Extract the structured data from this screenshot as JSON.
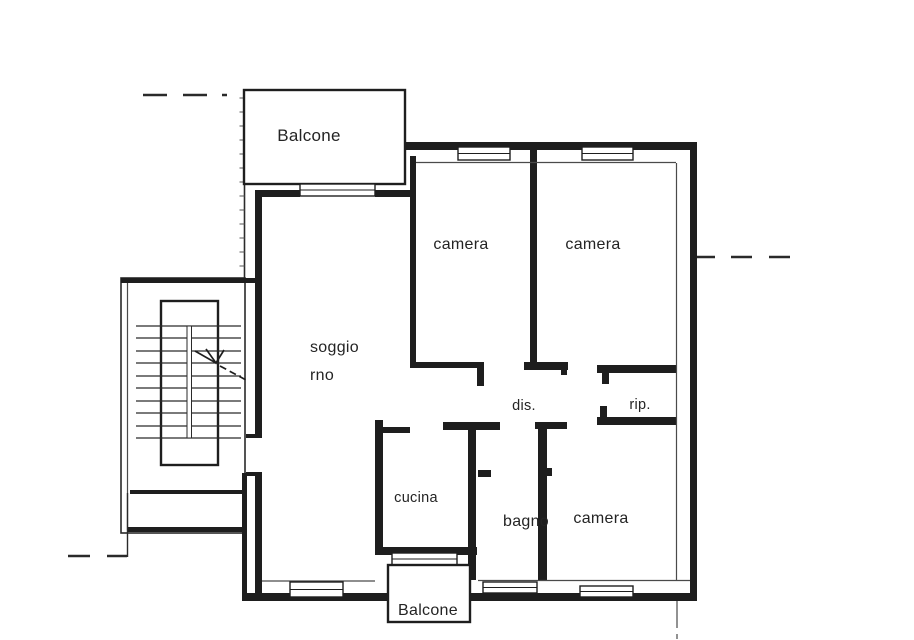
{
  "floor_plan": {
    "rooms": {
      "balcony_top": {
        "label": "Balcone"
      },
      "bedroom_top_left": {
        "label": "camera"
      },
      "bedroom_top_right": {
        "label": "camera"
      },
      "living_room": {
        "label_line1": "soggio",
        "label_line2": "rno"
      },
      "hallway": {
        "label": "dis."
      },
      "storage": {
        "label": "rip."
      },
      "kitchen": {
        "label": "cucina"
      },
      "bathroom": {
        "label": "bagno"
      },
      "bedroom_bottom": {
        "label": "camera"
      },
      "balcony_bottom": {
        "label": "Balcone"
      }
    },
    "colors": {
      "wall": "#1e1e1e",
      "thin_line": "#4a4a4a",
      "background": "#ffffff",
      "text": "#242424"
    }
  }
}
